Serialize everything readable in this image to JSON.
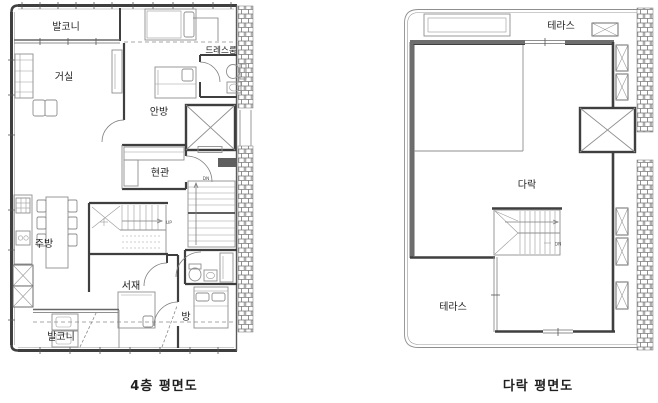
{
  "colors": {
    "background": "#ffffff",
    "wall": "#3f3f3f",
    "wall_medium": "#6e6e6e",
    "furniture_line": "#8f8f8f",
    "hatch": "#6a6a6a",
    "text": "#1f1f1f"
  },
  "floor4": {
    "caption": "4층 평면도",
    "labels": {
      "balcony_top": "발코니",
      "living": "거실",
      "dressroom": "드레스룸",
      "master": "안방",
      "entrance": "현관",
      "kitchen": "주방",
      "study": "서재",
      "room": "방",
      "balcony_bottom": "발코니",
      "stair_up": "UP",
      "stair_dn": "DN"
    }
  },
  "attic": {
    "caption": "다락 평면도",
    "labels": {
      "terrace_top": "테라스",
      "attic": "다락",
      "terrace_bottom": "테라스",
      "stair_dn": "DN"
    }
  }
}
